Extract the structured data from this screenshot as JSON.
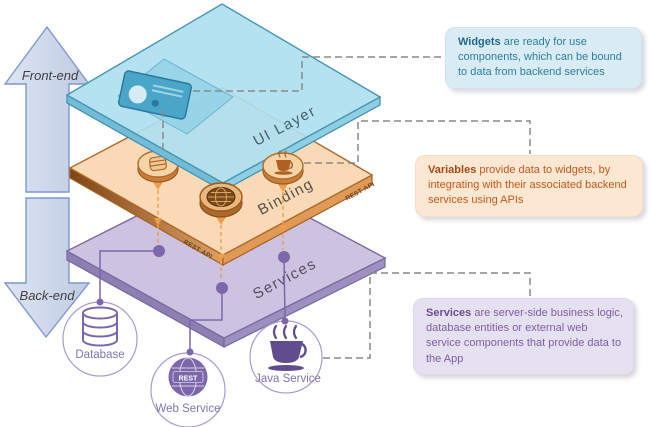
{
  "arrows": {
    "front_label": "Front-end",
    "back_label": "Back-end"
  },
  "layers": {
    "ui": {
      "label": "UI Layer"
    },
    "binding": {
      "label": "Binding",
      "edge_label": "REST API"
    },
    "services": {
      "label": "Services"
    }
  },
  "callouts": {
    "widgets": {
      "lead": "Widgets",
      "body": " are ready for use components, which can be bound to data from backend services"
    },
    "variables": {
      "lead": "Variables",
      "body": " provide data to widgets, by integrating with their associated backend services using APIs"
    },
    "services": {
      "lead": "Services",
      "body": " are server-side business logic, database entities or external web service components that provide data to the App"
    }
  },
  "backend_nodes": {
    "database": {
      "label": "Database"
    },
    "web_service": {
      "label": "Web Service",
      "badge": "REST"
    },
    "java_service": {
      "label": "Java Service"
    }
  },
  "icons": {
    "front_arrow": "up-arrow",
    "back_arrow": "down-arrow",
    "ui_widget": "id-card-icon",
    "binding_coins": [
      "database-coin-icon",
      "globe-coin-icon",
      "coffee-coin-icon"
    ],
    "database": "database-cylinder-icon",
    "web_service": "globe-rest-icon",
    "java_service": "coffee-cup-icon"
  },
  "colors": {
    "ui_layer": "#aedff0",
    "binding_layer": "#f9d9b6",
    "services_layer": "#cdc3e1",
    "callout_widgets_bg": "#d9ecf5",
    "callout_variables_bg": "#fbe7d2",
    "callout_services_bg": "#e6e1f1",
    "widgets_text": "#2e7d9e",
    "variables_text": "#c05a1e",
    "services_text": "#7b5ea6",
    "connector_gray": "#8a8a8a",
    "connector_orange": "#f0a050",
    "purple_accent": "#7c67ab"
  }
}
